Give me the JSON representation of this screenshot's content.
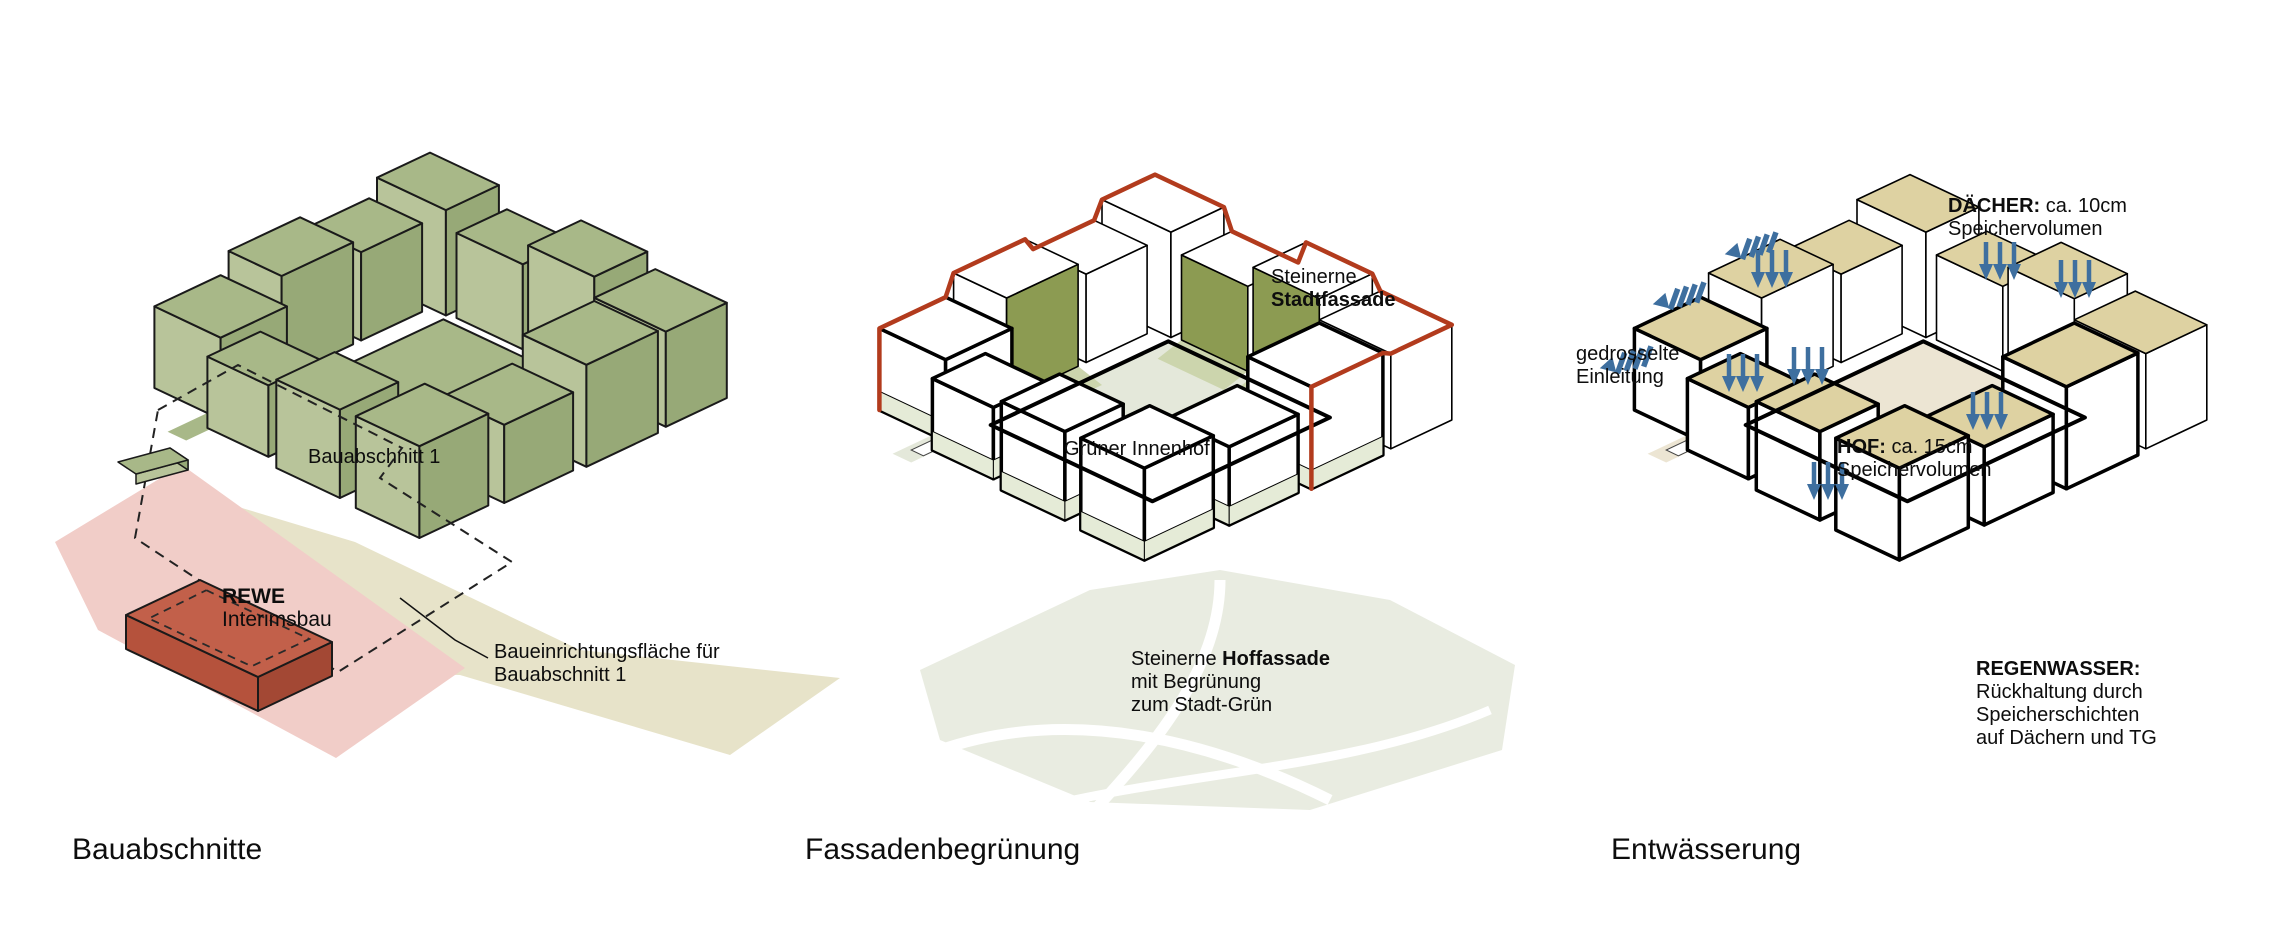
{
  "colors": {
    "outline": "#1a1a1a",
    "p1_roof": "#a8b888",
    "p1_wall_left": "#b8c49a",
    "p1_wall_right": "#97a977",
    "p1_ground_beige": "#e7e3c9",
    "p1_ground_pink": "#f1cdc8",
    "p1_rewe_top": "#c2604a",
    "p1_rewe_left": "#b5523c",
    "p1_rewe_right": "#a34834",
    "p2_outline": "#000000",
    "p2_face_white": "#ffffff",
    "p2_green_facade": "#8c9b52",
    "p2_facade_shadow": "#ccd5ad",
    "p2_courtyard": "#e4e8da",
    "p2_plinth": "#e5ebd7",
    "p2_rim_red": "#b23b1d",
    "p2_ground": "#e9ece1",
    "p3_roof": "#ded2a2",
    "p3_courtyard": "#ece5d3",
    "p3_arrow_blue": "#3e6f9f"
  },
  "panel1": {
    "title": "Bauabschnitte",
    "area_label": "Bauabschnitt 1",
    "rewe_line1": "REWE",
    "rewe_line2": "Interimsbau",
    "leader_line1": "Baueinrichtungsfläche für",
    "leader_line2": "Bauabschnitt 1"
  },
  "panel2": {
    "title": "Fassadenbegrünung",
    "stadtfassade_line1": "Steinerne",
    "stadtfassade_line2": "Stadtfassade",
    "innenhof": "Grüner Innenhof",
    "hoffassade_regular": "Steinerne ",
    "hoffassade_bold": "Hoffassade",
    "hoffassade_line2": "mit Begrünung",
    "hoffassade_line3": "zum Stadt-Grün"
  },
  "panel3": {
    "title": "Entwässerung",
    "daecher_bold": "DÄCHER:",
    "daecher_rest": " ca. 10cm",
    "daecher_line2": "Speichervolumen",
    "einleitung_line1": "gedrosselte",
    "einleitung_line2": "Einleitung",
    "hof_bold": "HOF:",
    "hof_rest": " ca. 15cm",
    "hof_line2": "Speichervolumen",
    "regen_line1": "REGENWASSER:",
    "regen_line2": "Rückhaltung durch",
    "regen_line3": "Speicherschichten",
    "regen_line4": "auf Dächern und TG"
  }
}
